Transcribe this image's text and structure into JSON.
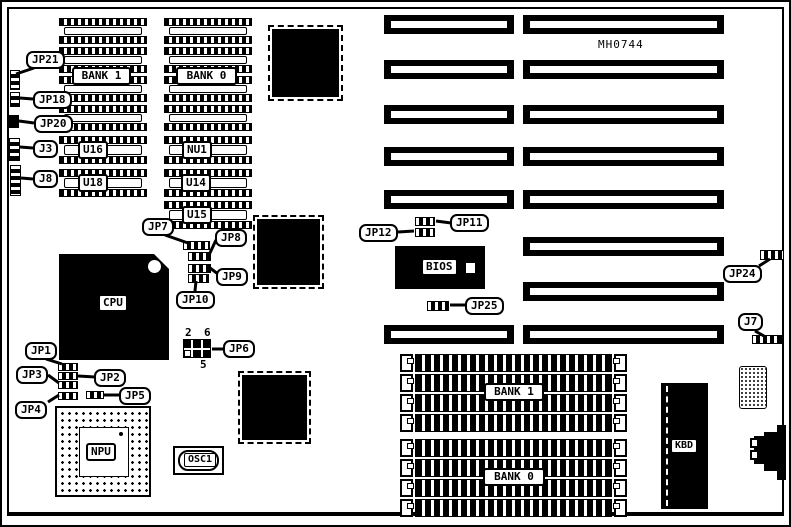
{
  "board": {
    "part_number": "MH0744"
  },
  "memory": {
    "dip_bank1": "BANK 1",
    "dip_bank0": "BANK 0",
    "simm_bank1": "BANK 1",
    "simm_bank0": "BANK 0"
  },
  "chips": {
    "cpu": "CPU",
    "npu": "NPU",
    "bios": "BIOS",
    "kbd": "KBD",
    "osc1": "OSC1",
    "nu1": "NU1",
    "u14": "U14",
    "u15": "U15",
    "u16": "U16",
    "u18": "U18"
  },
  "jumpers": {
    "jp1": "JP1",
    "jp2": "JP2",
    "jp3": "JP3",
    "jp4": "JP4",
    "jp5": "JP5",
    "jp6": "JP6",
    "jp7": "JP7",
    "jp8": "JP8",
    "jp9": "JP9",
    "jp10": "JP10",
    "jp11": "JP11",
    "jp12": "JP12",
    "jp18": "JP18",
    "jp20": "JP20",
    "jp21": "JP21",
    "jp24": "JP24",
    "jp25": "JP25",
    "j3": "J3",
    "j7": "J7",
    "j8": "J8"
  },
  "jp6_pin_labels": {
    "top_left": "2",
    "top_right": "6",
    "bottom": "5"
  },
  "colors": {
    "ink": "#000000",
    "paper": "#ffffff"
  }
}
